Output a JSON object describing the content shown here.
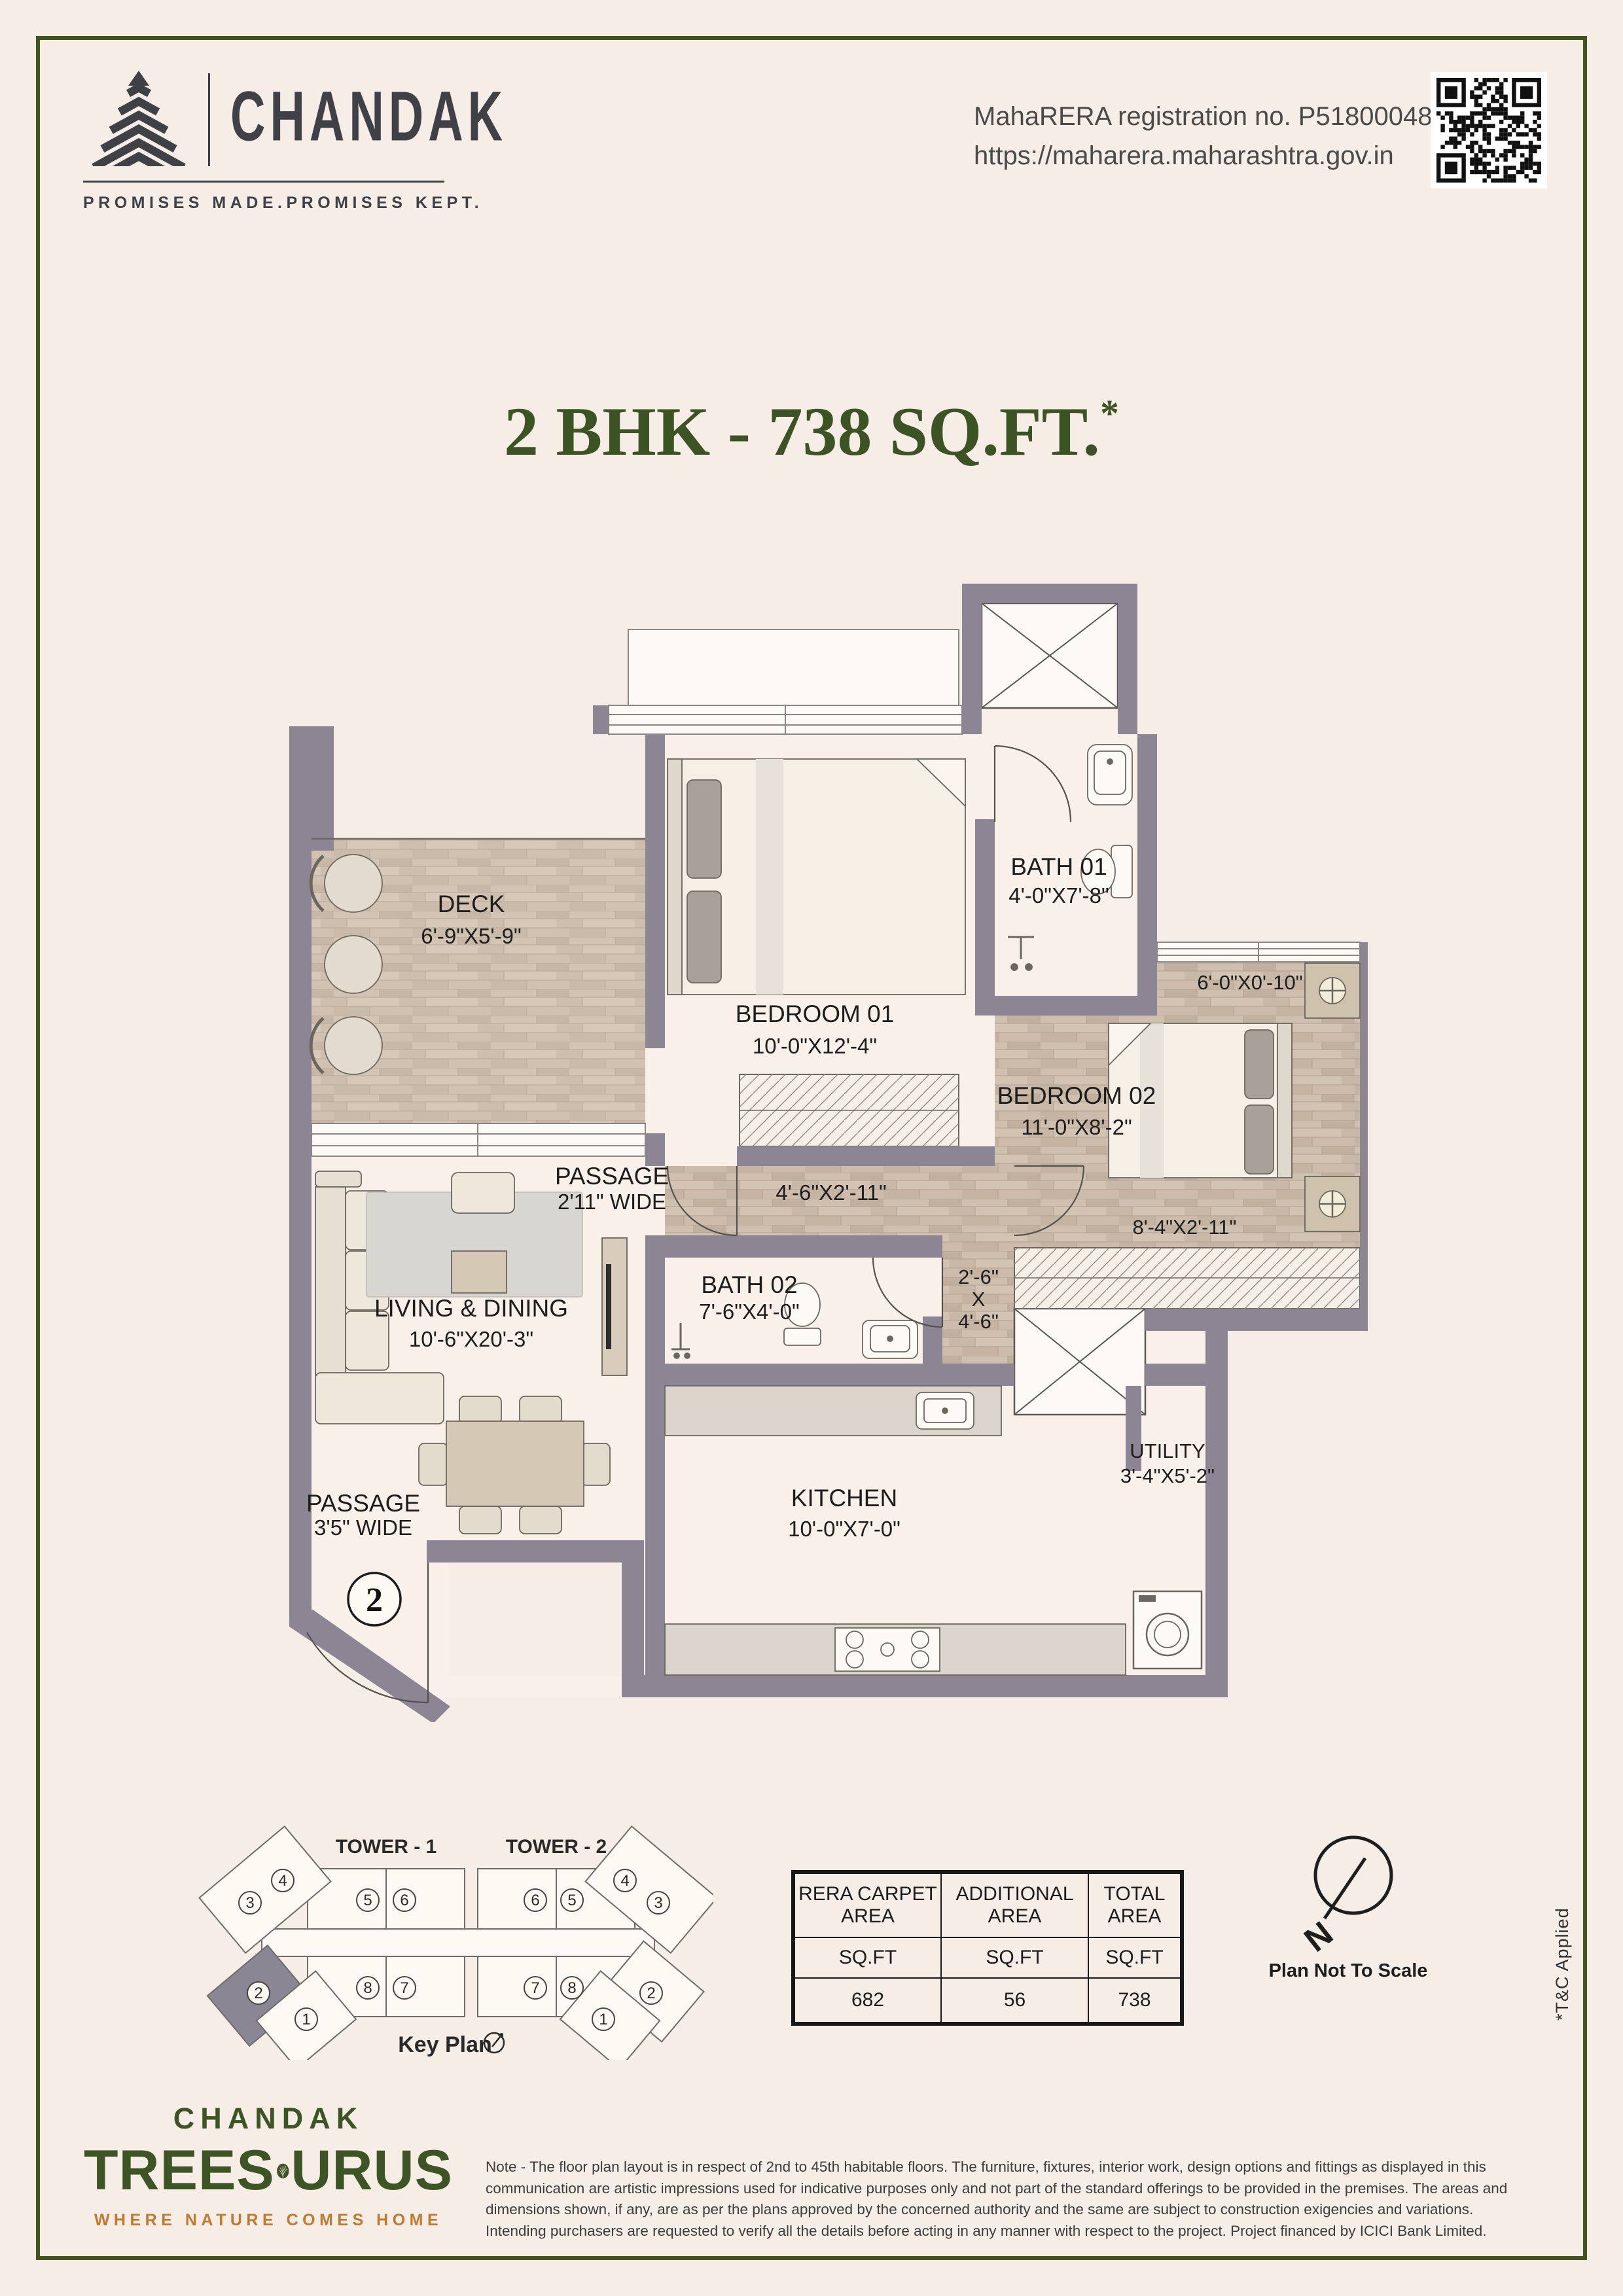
{
  "colors": {
    "page_bg": "#f6ede6",
    "border_green": "#42541e",
    "title_green": "#3c5323",
    "brand_dark": "#3f4147",
    "logo_green": "#3d5425",
    "logo_orange": "#c07a2b",
    "wall_gray": "#8b8594",
    "wood": "#c9b9a8"
  },
  "header": {
    "brand": "CHANDAK",
    "tagline": "PROMISES MADE.PROMISES KEPT.",
    "rera_line1": "MahaRERA registration no. P51800048658",
    "rera_line2": "https://maharera.maharashtra.gov.in"
  },
  "title": {
    "main": "2 BHK - 738 SQ.FT.",
    "asterisk": "*"
  },
  "plan": {
    "unit_number": "2",
    "rooms": {
      "deck": {
        "name": "DECK",
        "dim": "6'-9\"X5'-9\""
      },
      "bedroom01": {
        "name": "BEDROOM 01",
        "dim": "10'-0\"X12'-4\""
      },
      "bath01": {
        "name": "BATH 01",
        "dim": "4'-0\"X7'-8\""
      },
      "bedroom02": {
        "name": "BEDROOM 02",
        "dim": "11'-0\"X8'-2\""
      },
      "bath02": {
        "name": "BATH 02",
        "dim": "7'-6\"X4'-0\""
      },
      "living": {
        "name": "LIVING & DINING",
        "dim": "10'-6\"X20'-3\""
      },
      "kitchen": {
        "name": "KITCHEN",
        "dim": "10'-0\"X7'-0\""
      },
      "utility": {
        "name": "UTILITY",
        "dim": "3'-4\"X5'-2\""
      },
      "passage1": {
        "name": "PASSAGE",
        "dim": "2'11\" WIDE"
      },
      "passage2": {
        "name": "PASSAGE",
        "dim": "3'5\" WIDE"
      }
    },
    "dims": {
      "corridor": "4'-6\"X2'-11\"",
      "foyer_w": "2'-6\"",
      "foyer_x": "X",
      "foyer_h": "4'-6\"",
      "bed02_deck": "6'-0\"X0'-10\"",
      "bed02_wardrobe": "8'-4\"X2'-11\""
    }
  },
  "keyplan": {
    "tower1": "TOWER - 1",
    "tower2": "TOWER - 2",
    "label": "Key Plan",
    "t1_upper": [
      "5",
      "6"
    ],
    "t1_lower": [
      "8",
      "7"
    ],
    "t2_upper": [
      "6",
      "5"
    ],
    "t2_lower": [
      "7",
      "8"
    ],
    "tl": [
      "3",
      "4"
    ],
    "tr": [
      "4",
      "3"
    ],
    "bl": [
      "2",
      "1"
    ],
    "br": [
      "1",
      "2"
    ]
  },
  "area_table": {
    "columns": [
      {
        "l1": "RERA CARPET",
        "l2": "AREA",
        "unit": "SQ.FT",
        "value": "682"
      },
      {
        "l1": "ADDITIONAL",
        "l2": "AREA",
        "unit": "SQ.FT",
        "value": "56"
      },
      {
        "l1": "TOTAL",
        "l2": "AREA",
        "unit": "SQ.FT",
        "value": "738"
      }
    ]
  },
  "compass": {
    "n": "N",
    "note": "Plan Not To Scale"
  },
  "tnc": "*T&C Applied",
  "footer": {
    "logo_top": "CHANDAK",
    "logo_main_left": "TREES",
    "logo_main_right": "URUS",
    "logo_tagline": "WHERE NATURE COMES HOME",
    "note": "Note - The floor plan layout is in respect of 2nd to 45th habitable floors. The furniture, fixtures, interior work, design options and fittings as displayed in this communication are artistic impressions used for indicative purposes only and not part of the standard offerings to be provided in the premises. The areas and dimensions shown, if any, are as per the plans approved by the concerned authority and the same are subject to construction exigencies and variations. Intending purchasers are requested to verify all the details before acting in any manner with respect to the project. Project financed by ICICI Bank Limited."
  }
}
